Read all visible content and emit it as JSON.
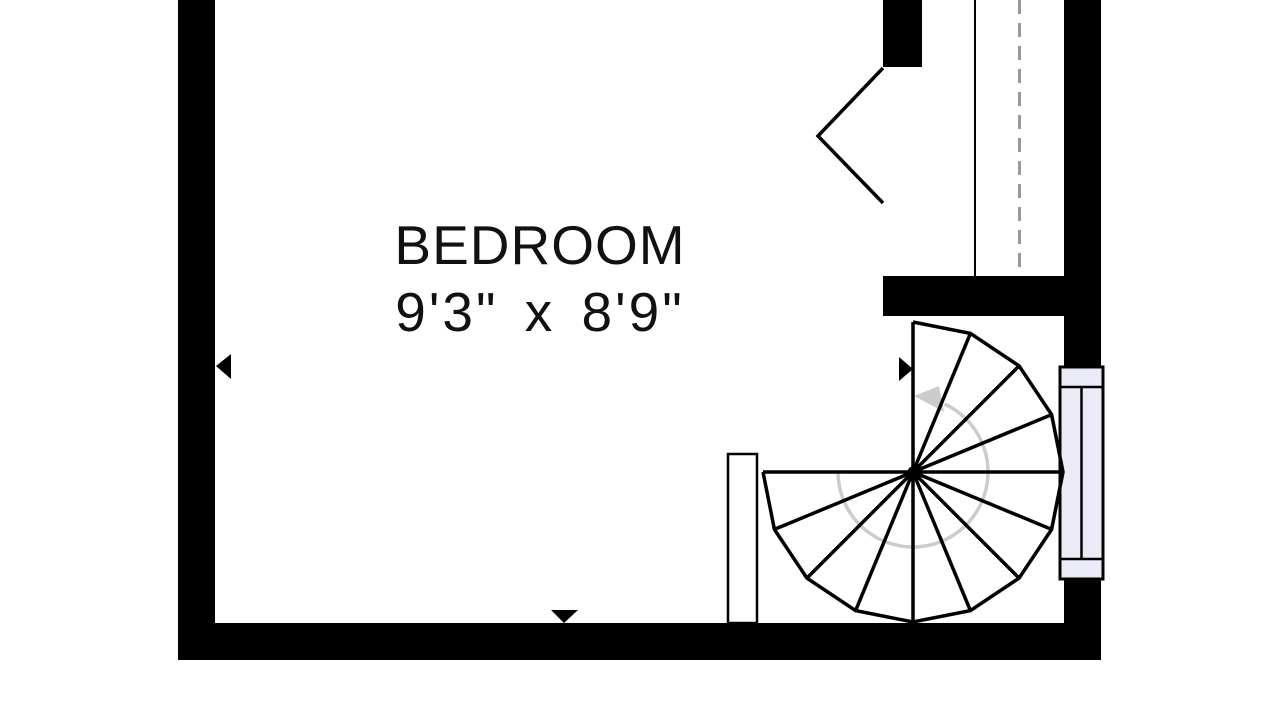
{
  "room": {
    "name": "BEDROOM",
    "dimensions": "9'3\" x 8'9\""
  },
  "colors": {
    "wall": "#000000",
    "line": "#000000",
    "window_fill": "#ebebf7",
    "window_frame": "#000000",
    "door_leaf_fill": "#ffffff",
    "stair_guide": "#cccccc",
    "overhead_dashed": "#999999",
    "background": "#ffffff",
    "label_text": "#111111"
  },
  "icons": {
    "stair_direction": "curved-arrow-counterclockwise",
    "dimension_marker_left": "triangle-left",
    "dimension_marker_right": "triangle-right",
    "dimension_marker_down": "triangle-down"
  }
}
